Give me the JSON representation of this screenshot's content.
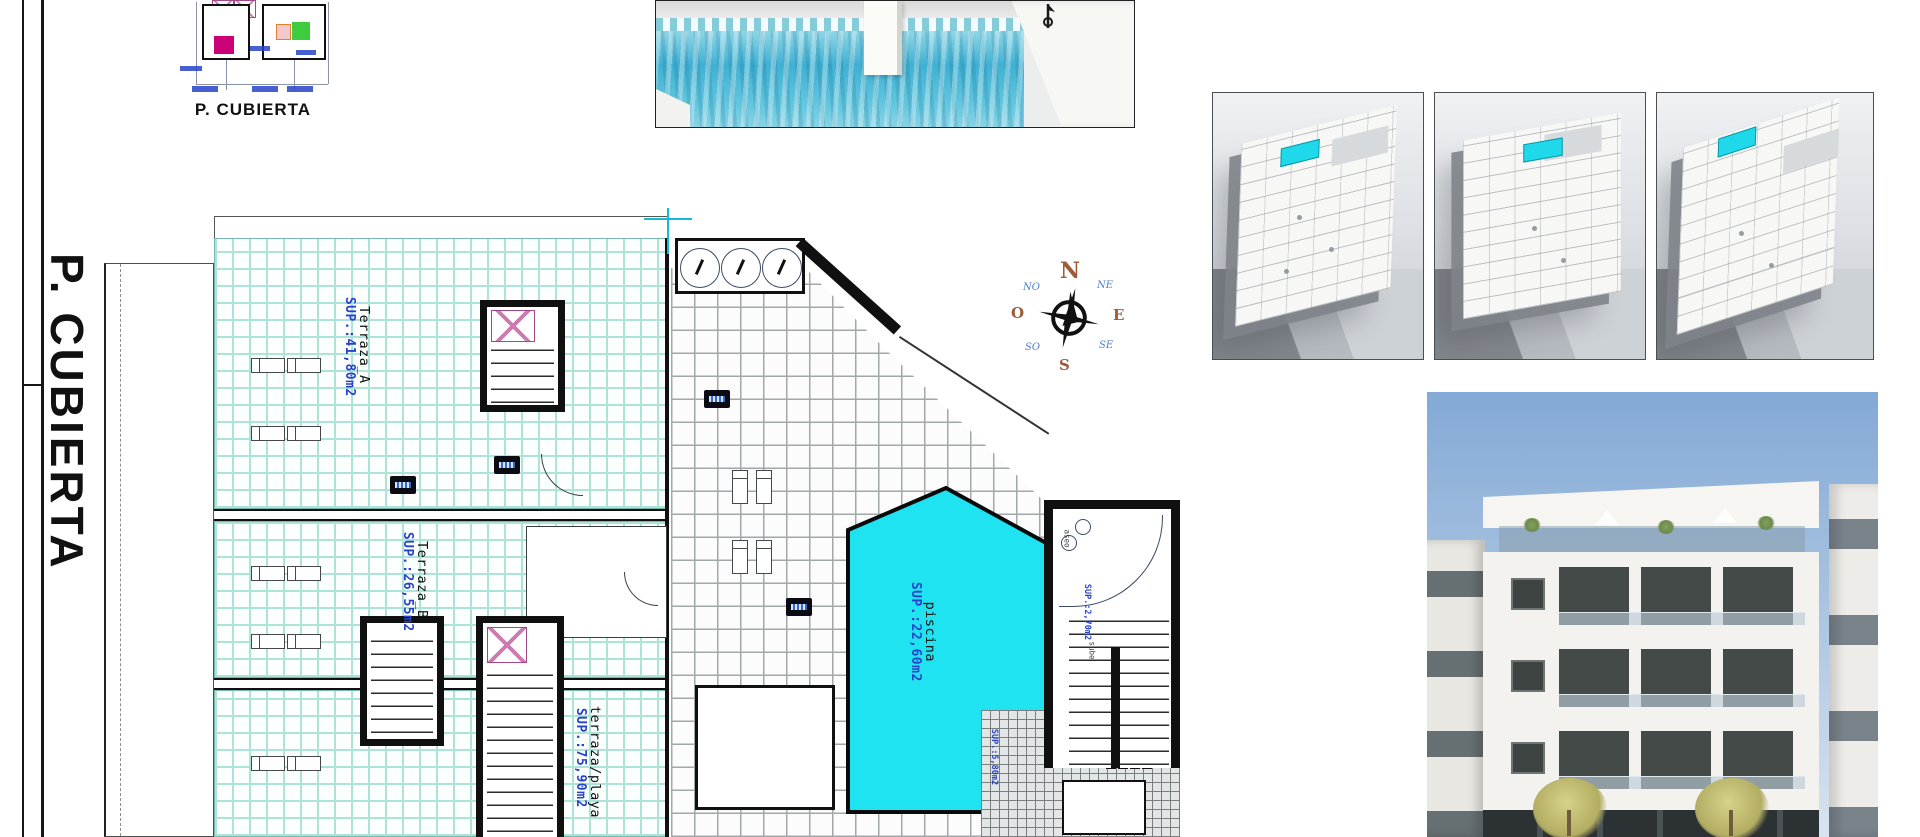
{
  "titles": {
    "key_plan": "P. CUBIERTA",
    "side": "P. CUBIERTA"
  },
  "plan": {
    "rooms": [
      {
        "name": "Terraza_A",
        "area": "SUP.:41,80m2"
      },
      {
        "name": "Terraza_B",
        "area": "SUP.:26,55m2"
      },
      {
        "name": "terraza/playa",
        "area": "SUP.:75,90m2"
      },
      {
        "name": "piscina",
        "area": "SUP.:22,60m2"
      }
    ],
    "annotations": [
      {
        "text": "SUP.:2,70m2"
      },
      {
        "text": "SUP.:5,80m2"
      },
      {
        "text": "aseo"
      },
      {
        "text": "sube"
      }
    ]
  },
  "compass": {
    "n": "N",
    "ne": "NE",
    "e": "E",
    "se": "SE",
    "s": "S",
    "so": "SO",
    "o": "O",
    "no": "NO"
  },
  "colors": {
    "pool_cyan": "#1fe3f1",
    "tile_grout_teal": "#aee3da",
    "tile_grout_grey": "#a2a7a7",
    "annotation_blue": "#2743c9",
    "hatch_pink": "#cc7ab0",
    "highlight_magenta": "#cc0077",
    "highlight_green": "#3ecc3e",
    "highlight_orange": "#e08030"
  }
}
